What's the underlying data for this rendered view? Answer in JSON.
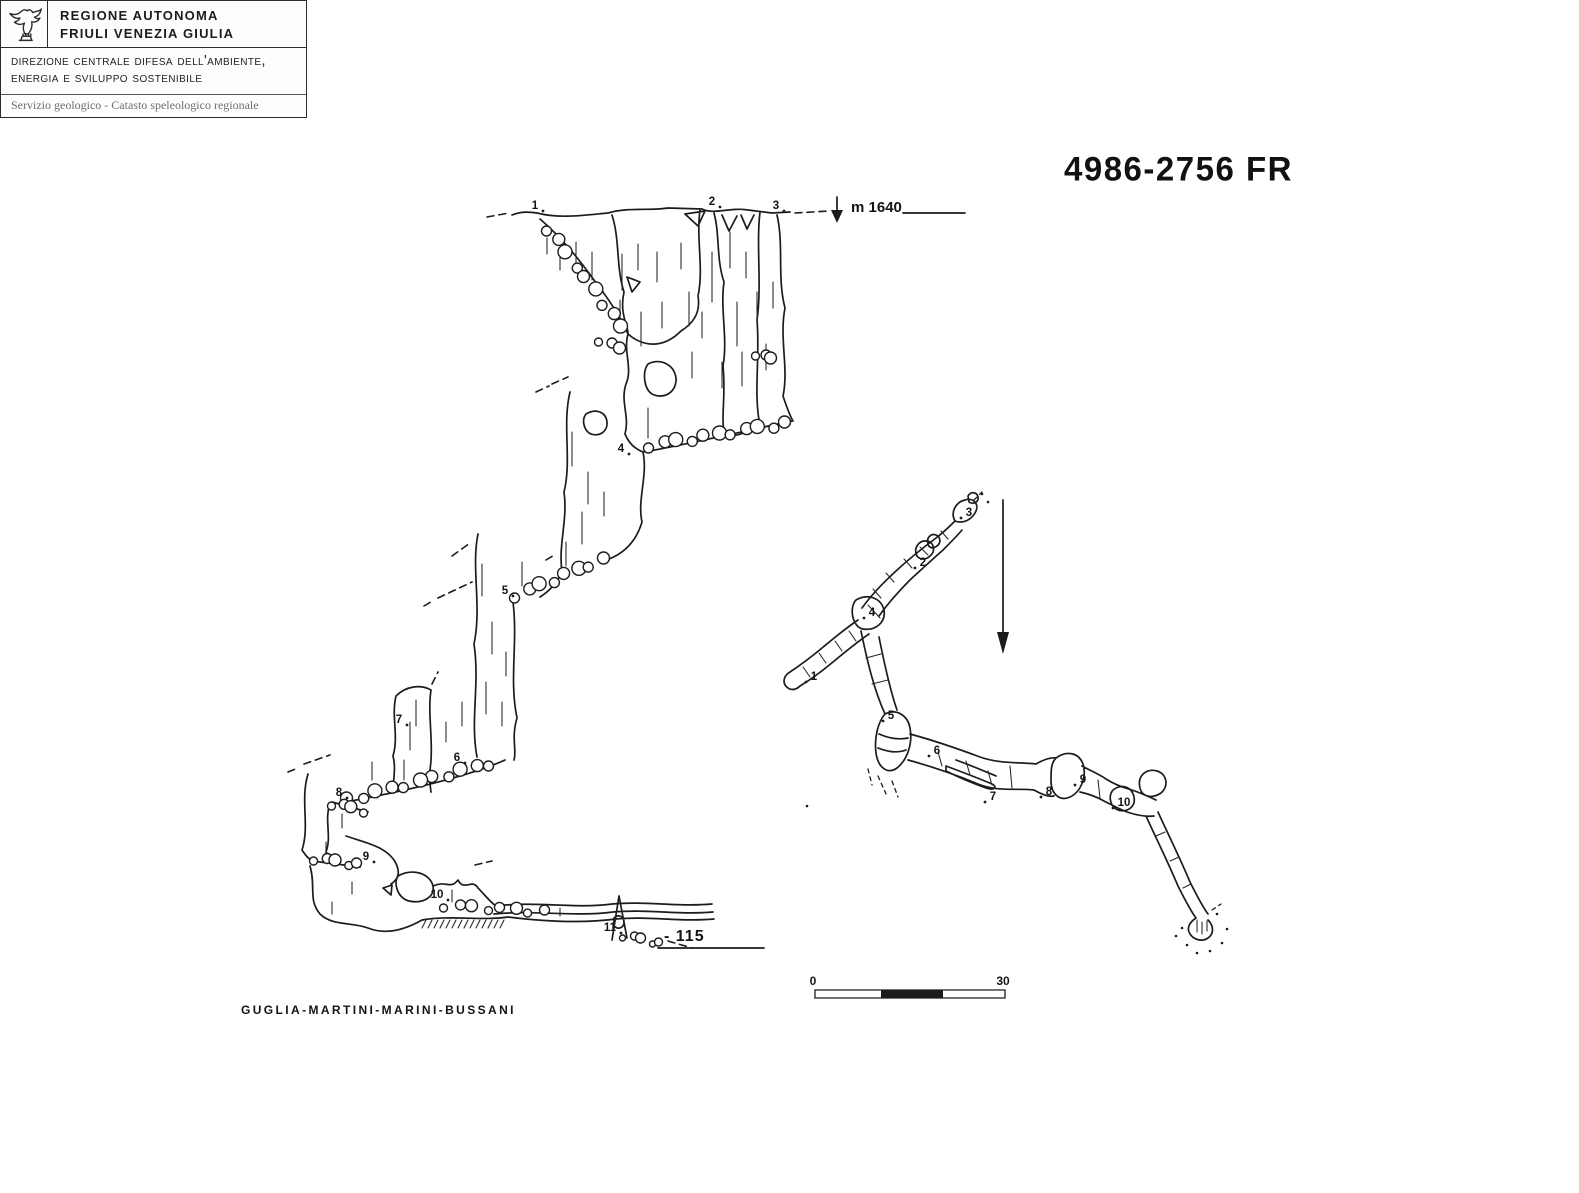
{
  "colors": {
    "ink": "#1c1c1c",
    "paper": "#ffffff",
    "muted": "#6e6e6e"
  },
  "header": {
    "logo": "fvg-eagle",
    "region_line1": "REGIONE AUTONOMA",
    "region_line2": "FRIULI VENEZIA GIULIA",
    "department_line1": "direzione centrale difesa dell'ambiente,",
    "department_line2": "energia e sviluppo sostenibile",
    "service": "Servizio geologico - Catasto speleologico regionale"
  },
  "title": "4986-2756 FR",
  "survey": {
    "altitude_label": "m 1640",
    "depth_label": "- 115",
    "authors": "GUGLIA-MARTINI-MARINI-BUSSANI",
    "scale_bar": {
      "start": "0",
      "end": "30"
    },
    "profile_stations": [
      {
        "label": "1",
        "x": 535,
        "y": 209
      },
      {
        "label": "2",
        "x": 712,
        "y": 205
      },
      {
        "label": "3",
        "x": 776,
        "y": 209
      },
      {
        "label": "4",
        "x": 621,
        "y": 452
      },
      {
        "label": "5",
        "x": 505,
        "y": 594
      },
      {
        "label": "6",
        "x": 457,
        "y": 761
      },
      {
        "label": "7",
        "x": 399,
        "y": 723
      },
      {
        "label": "8",
        "x": 339,
        "y": 796
      },
      {
        "label": "9",
        "x": 366,
        "y": 860
      },
      {
        "label": "10",
        "x": 437,
        "y": 898
      },
      {
        "label": "11",
        "x": 610,
        "y": 931
      }
    ],
    "plan_stations": [
      {
        "label": "1",
        "x": 814,
        "y": 680
      },
      {
        "label": "2",
        "x": 923,
        "y": 566
      },
      {
        "label": "3",
        "x": 969,
        "y": 516
      },
      {
        "label": "4",
        "x": 872,
        "y": 616
      },
      {
        "label": "5",
        "x": 891,
        "y": 719
      },
      {
        "label": "6",
        "x": 937,
        "y": 754
      },
      {
        "label": "7",
        "x": 993,
        "y": 800
      },
      {
        "label": "8",
        "x": 1049,
        "y": 795
      },
      {
        "label": "9",
        "x": 1083,
        "y": 783
      },
      {
        "label": "10",
        "x": 1124,
        "y": 806
      }
    ]
  }
}
